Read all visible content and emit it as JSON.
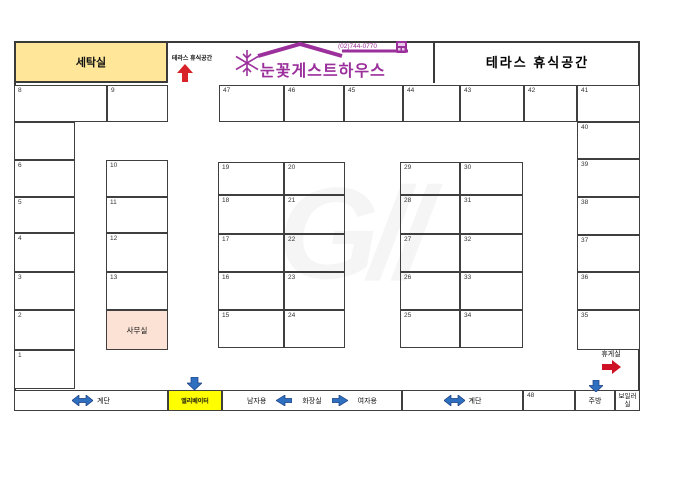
{
  "brand": {
    "name": "눈꽃게스트하우스",
    "phone": "(02)744-0770"
  },
  "header": {
    "laundry": "세탁실",
    "terrace_entrance": "테라스 휴식공간",
    "terrace_lounge": "테라스 휴식공간"
  },
  "facilities": {
    "lounge": "휴게실",
    "stairs_left": "계단",
    "elevator": "엘리베이터",
    "mens": "남자용",
    "restroom": "화장실",
    "womens": "여자용",
    "stairs_right": "계단",
    "kitchen": "주방",
    "boiler": "보일러실"
  },
  "watermark": "G//",
  "colors": {
    "laundry_fill": "#ffe699",
    "office_fill": "#fbe2d5",
    "elevator_fill": "#ffff00",
    "brand_purple": "#9b2f9b",
    "arrow_red": "#d8232a",
    "arrow_blue": "#2f6fc0",
    "wall_line": "#3a3a3a"
  },
  "icons": {
    "snowflake-logo-icon": "❆",
    "phone-badge-icon": "▦",
    "terrace-up-arrow": "▲ red",
    "lounge-right-arrow": "► red",
    "stairs-left-arrow": "↔ blue",
    "stairs-right-arrow": "↔ blue",
    "elevator-down-arrow": "▼ blue",
    "kitchen-down-arrow": "▼ blue",
    "mens-left-arrow": "◄ blue",
    "womens-right-arrow": "► blue"
  },
  "rooms": [
    {
      "n": "8",
      "x": 14,
      "y": 85,
      "w": 93,
      "h": 37
    },
    {
      "n": "9",
      "x": 107,
      "y": 85,
      "w": 61,
      "h": 37
    },
    {
      "n": "47",
      "x": 219,
      "y": 85,
      "w": 65,
      "h": 37
    },
    {
      "n": "46",
      "x": 284,
      "y": 85,
      "w": 60,
      "h": 37
    },
    {
      "n": "45",
      "x": 344,
      "y": 85,
      "w": 59,
      "h": 37
    },
    {
      "n": "44",
      "x": 403,
      "y": 85,
      "w": 57,
      "h": 37
    },
    {
      "n": "43",
      "x": 460,
      "y": 85,
      "w": 64,
      "h": 37
    },
    {
      "n": "42",
      "x": 524,
      "y": 85,
      "w": 53,
      "h": 37
    },
    {
      "n": "41",
      "x": 577,
      "y": 85,
      "w": 63,
      "h": 37
    },
    {
      "n": "",
      "x": 14,
      "y": 122,
      "w": 61,
      "h": 38
    },
    {
      "n": "6",
      "x": 14,
      "y": 160,
      "w": 61,
      "h": 37
    },
    {
      "n": "5",
      "x": 14,
      "y": 197,
      "w": 61,
      "h": 36
    },
    {
      "n": "4",
      "x": 14,
      "y": 233,
      "w": 61,
      "h": 39
    },
    {
      "n": "3",
      "x": 14,
      "y": 272,
      "w": 61,
      "h": 38
    },
    {
      "n": "2",
      "x": 14,
      "y": 310,
      "w": 61,
      "h": 40
    },
    {
      "n": "1",
      "x": 14,
      "y": 350,
      "w": 61,
      "h": 39
    },
    {
      "n": "10",
      "x": 106,
      "y": 160,
      "w": 62,
      "h": 37
    },
    {
      "n": "11",
      "x": 106,
      "y": 197,
      "w": 62,
      "h": 36
    },
    {
      "n": "12",
      "x": 106,
      "y": 233,
      "w": 62,
      "h": 39
    },
    {
      "n": "13",
      "x": 106,
      "y": 272,
      "w": 62,
      "h": 38
    },
    {
      "n": "사무실",
      "x": 106,
      "y": 310,
      "w": 62,
      "h": 40,
      "fill": "#fbe2d5",
      "center": true
    },
    {
      "n": "19",
      "x": 218,
      "y": 162,
      "w": 66,
      "h": 33
    },
    {
      "n": "20",
      "x": 284,
      "y": 162,
      "w": 61,
      "h": 33
    },
    {
      "n": "18",
      "x": 218,
      "y": 195,
      "w": 66,
      "h": 39
    },
    {
      "n": "21",
      "x": 284,
      "y": 195,
      "w": 61,
      "h": 39
    },
    {
      "n": "17",
      "x": 218,
      "y": 234,
      "w": 66,
      "h": 38
    },
    {
      "n": "22",
      "x": 284,
      "y": 234,
      "w": 61,
      "h": 38
    },
    {
      "n": "16",
      "x": 218,
      "y": 272,
      "w": 66,
      "h": 38
    },
    {
      "n": "23",
      "x": 284,
      "y": 272,
      "w": 61,
      "h": 38
    },
    {
      "n": "15",
      "x": 218,
      "y": 310,
      "w": 66,
      "h": 38
    },
    {
      "n": "24",
      "x": 284,
      "y": 310,
      "w": 61,
      "h": 38
    },
    {
      "n": "29",
      "x": 400,
      "y": 162,
      "w": 60,
      "h": 33
    },
    {
      "n": "30",
      "x": 460,
      "y": 162,
      "w": 63,
      "h": 33
    },
    {
      "n": "28",
      "x": 400,
      "y": 195,
      "w": 60,
      "h": 39
    },
    {
      "n": "31",
      "x": 460,
      "y": 195,
      "w": 63,
      "h": 39
    },
    {
      "n": "27",
      "x": 400,
      "y": 234,
      "w": 60,
      "h": 38
    },
    {
      "n": "32",
      "x": 460,
      "y": 234,
      "w": 63,
      "h": 38
    },
    {
      "n": "26",
      "x": 400,
      "y": 272,
      "w": 60,
      "h": 38
    },
    {
      "n": "33",
      "x": 460,
      "y": 272,
      "w": 63,
      "h": 38
    },
    {
      "n": "25",
      "x": 400,
      "y": 310,
      "w": 60,
      "h": 38
    },
    {
      "n": "34",
      "x": 460,
      "y": 310,
      "w": 63,
      "h": 38
    },
    {
      "n": "40",
      "x": 577,
      "y": 122,
      "w": 63,
      "h": 37
    },
    {
      "n": "39",
      "x": 577,
      "y": 159,
      "w": 63,
      "h": 38
    },
    {
      "n": "38",
      "x": 577,
      "y": 197,
      "w": 63,
      "h": 38
    },
    {
      "n": "37",
      "x": 577,
      "y": 235,
      "w": 63,
      "h": 37
    },
    {
      "n": "36",
      "x": 577,
      "y": 272,
      "w": 63,
      "h": 38
    },
    {
      "n": "35",
      "x": 577,
      "y": 310,
      "w": 63,
      "h": 40
    },
    {
      "n": "48",
      "x": 523,
      "y": 390,
      "w": 52,
      "h": 21
    }
  ]
}
